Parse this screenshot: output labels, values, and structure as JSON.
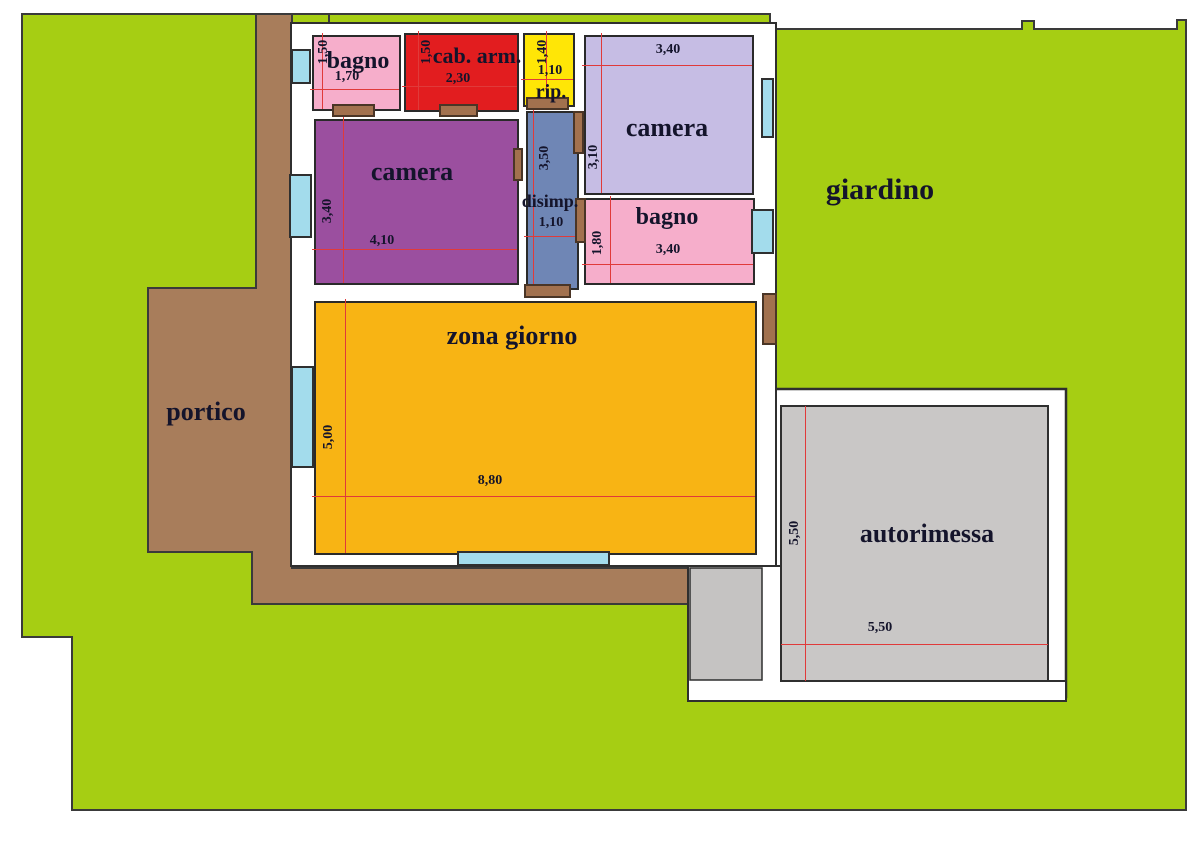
{
  "rooms": [
    {
      "id": "bagno1",
      "label": "bagno",
      "dim_h": "1,50",
      "dim_w": "1,70",
      "color": "#f6aecb"
    },
    {
      "id": "cab_arm",
      "label": "cab. arm.",
      "dim_h": "1,50",
      "dim_w": "2,30",
      "color": "#e21d1f"
    },
    {
      "id": "rip",
      "label": "rip.",
      "dim_h": "1,40",
      "dim_w": "1,10",
      "color": "#ffe606"
    },
    {
      "id": "camera_nord",
      "label": "camera",
      "dim_w": "3,40",
      "dim_h": "3,10",
      "color": "#c6bde4"
    },
    {
      "id": "camera_ovest",
      "label": "camera",
      "dim_h": "3,40",
      "dim_w": "4,10",
      "color": "#9b4f9f"
    },
    {
      "id": "disimpegno",
      "label": "disimp.",
      "dim_h": "3,50",
      "dim_w": "1,10",
      "color": "#6f86b5"
    },
    {
      "id": "bagno2",
      "label": "bagno",
      "dim_h": "1,80",
      "dim_w": "3,40",
      "color": "#f6aecb"
    },
    {
      "id": "zona_giorno",
      "label": "zona giorno",
      "dim_h": "5,00",
      "dim_w": "8,80",
      "color": "#f8b414"
    },
    {
      "id": "autorimessa",
      "label": "autorimessa",
      "dim_h": "5,50",
      "dim_w": "5,50",
      "color": "#c9c7c6"
    }
  ],
  "outdoor": [
    {
      "id": "giardino",
      "label": "giardino",
      "color": "#a6ce13"
    },
    {
      "id": "portico",
      "label": "portico",
      "color": "#a87d5b"
    }
  ],
  "colors": {
    "garden_green": "#a6ce13",
    "pavement_brown": "#a87d5b",
    "door_brown": "#a2714e",
    "window_cyan": "#a3dcec",
    "garage_gray": "#c9c7c6",
    "driveway_gray": "#c5c3c2",
    "wall_white": "#ffffff",
    "outline_dark": "#2f2f2f",
    "dimension_red": "#e03a3a",
    "text_dark": "#14142b"
  }
}
